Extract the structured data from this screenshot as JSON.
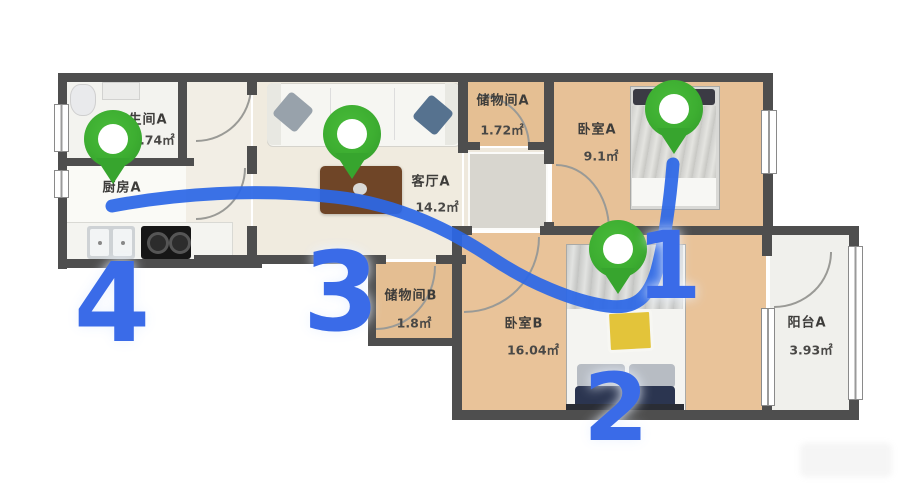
{
  "floorplan": {
    "rooms": [
      {
        "name": "卫生间A",
        "area": "2.74㎡"
      },
      {
        "name": "厨房A",
        "area": ""
      },
      {
        "name": "客厅A",
        "area": "14.2㎡"
      },
      {
        "name": "储物间A",
        "area": "1.72㎡"
      },
      {
        "name": "卧室A",
        "area": "9.1㎡"
      },
      {
        "name": "储物间B",
        "area": "1.8㎡"
      },
      {
        "name": "卧室B",
        "area": "16.04㎡"
      },
      {
        "name": "阳台A",
        "area": "3.93㎡"
      }
    ],
    "route": {
      "steps": [
        {
          "number": "1",
          "room": "卧室A"
        },
        {
          "number": "2",
          "room": "卧室B"
        },
        {
          "number": "3",
          "room": "客厅A"
        },
        {
          "number": "4",
          "room": "厨房A"
        }
      ]
    },
    "colors": {
      "pin_green": "#3dae31",
      "route_blue": "#2c67e6",
      "number_blue": "#3a6be8",
      "wall_gray": "#4e4e4e",
      "wood_floor": "#e8c298"
    }
  }
}
